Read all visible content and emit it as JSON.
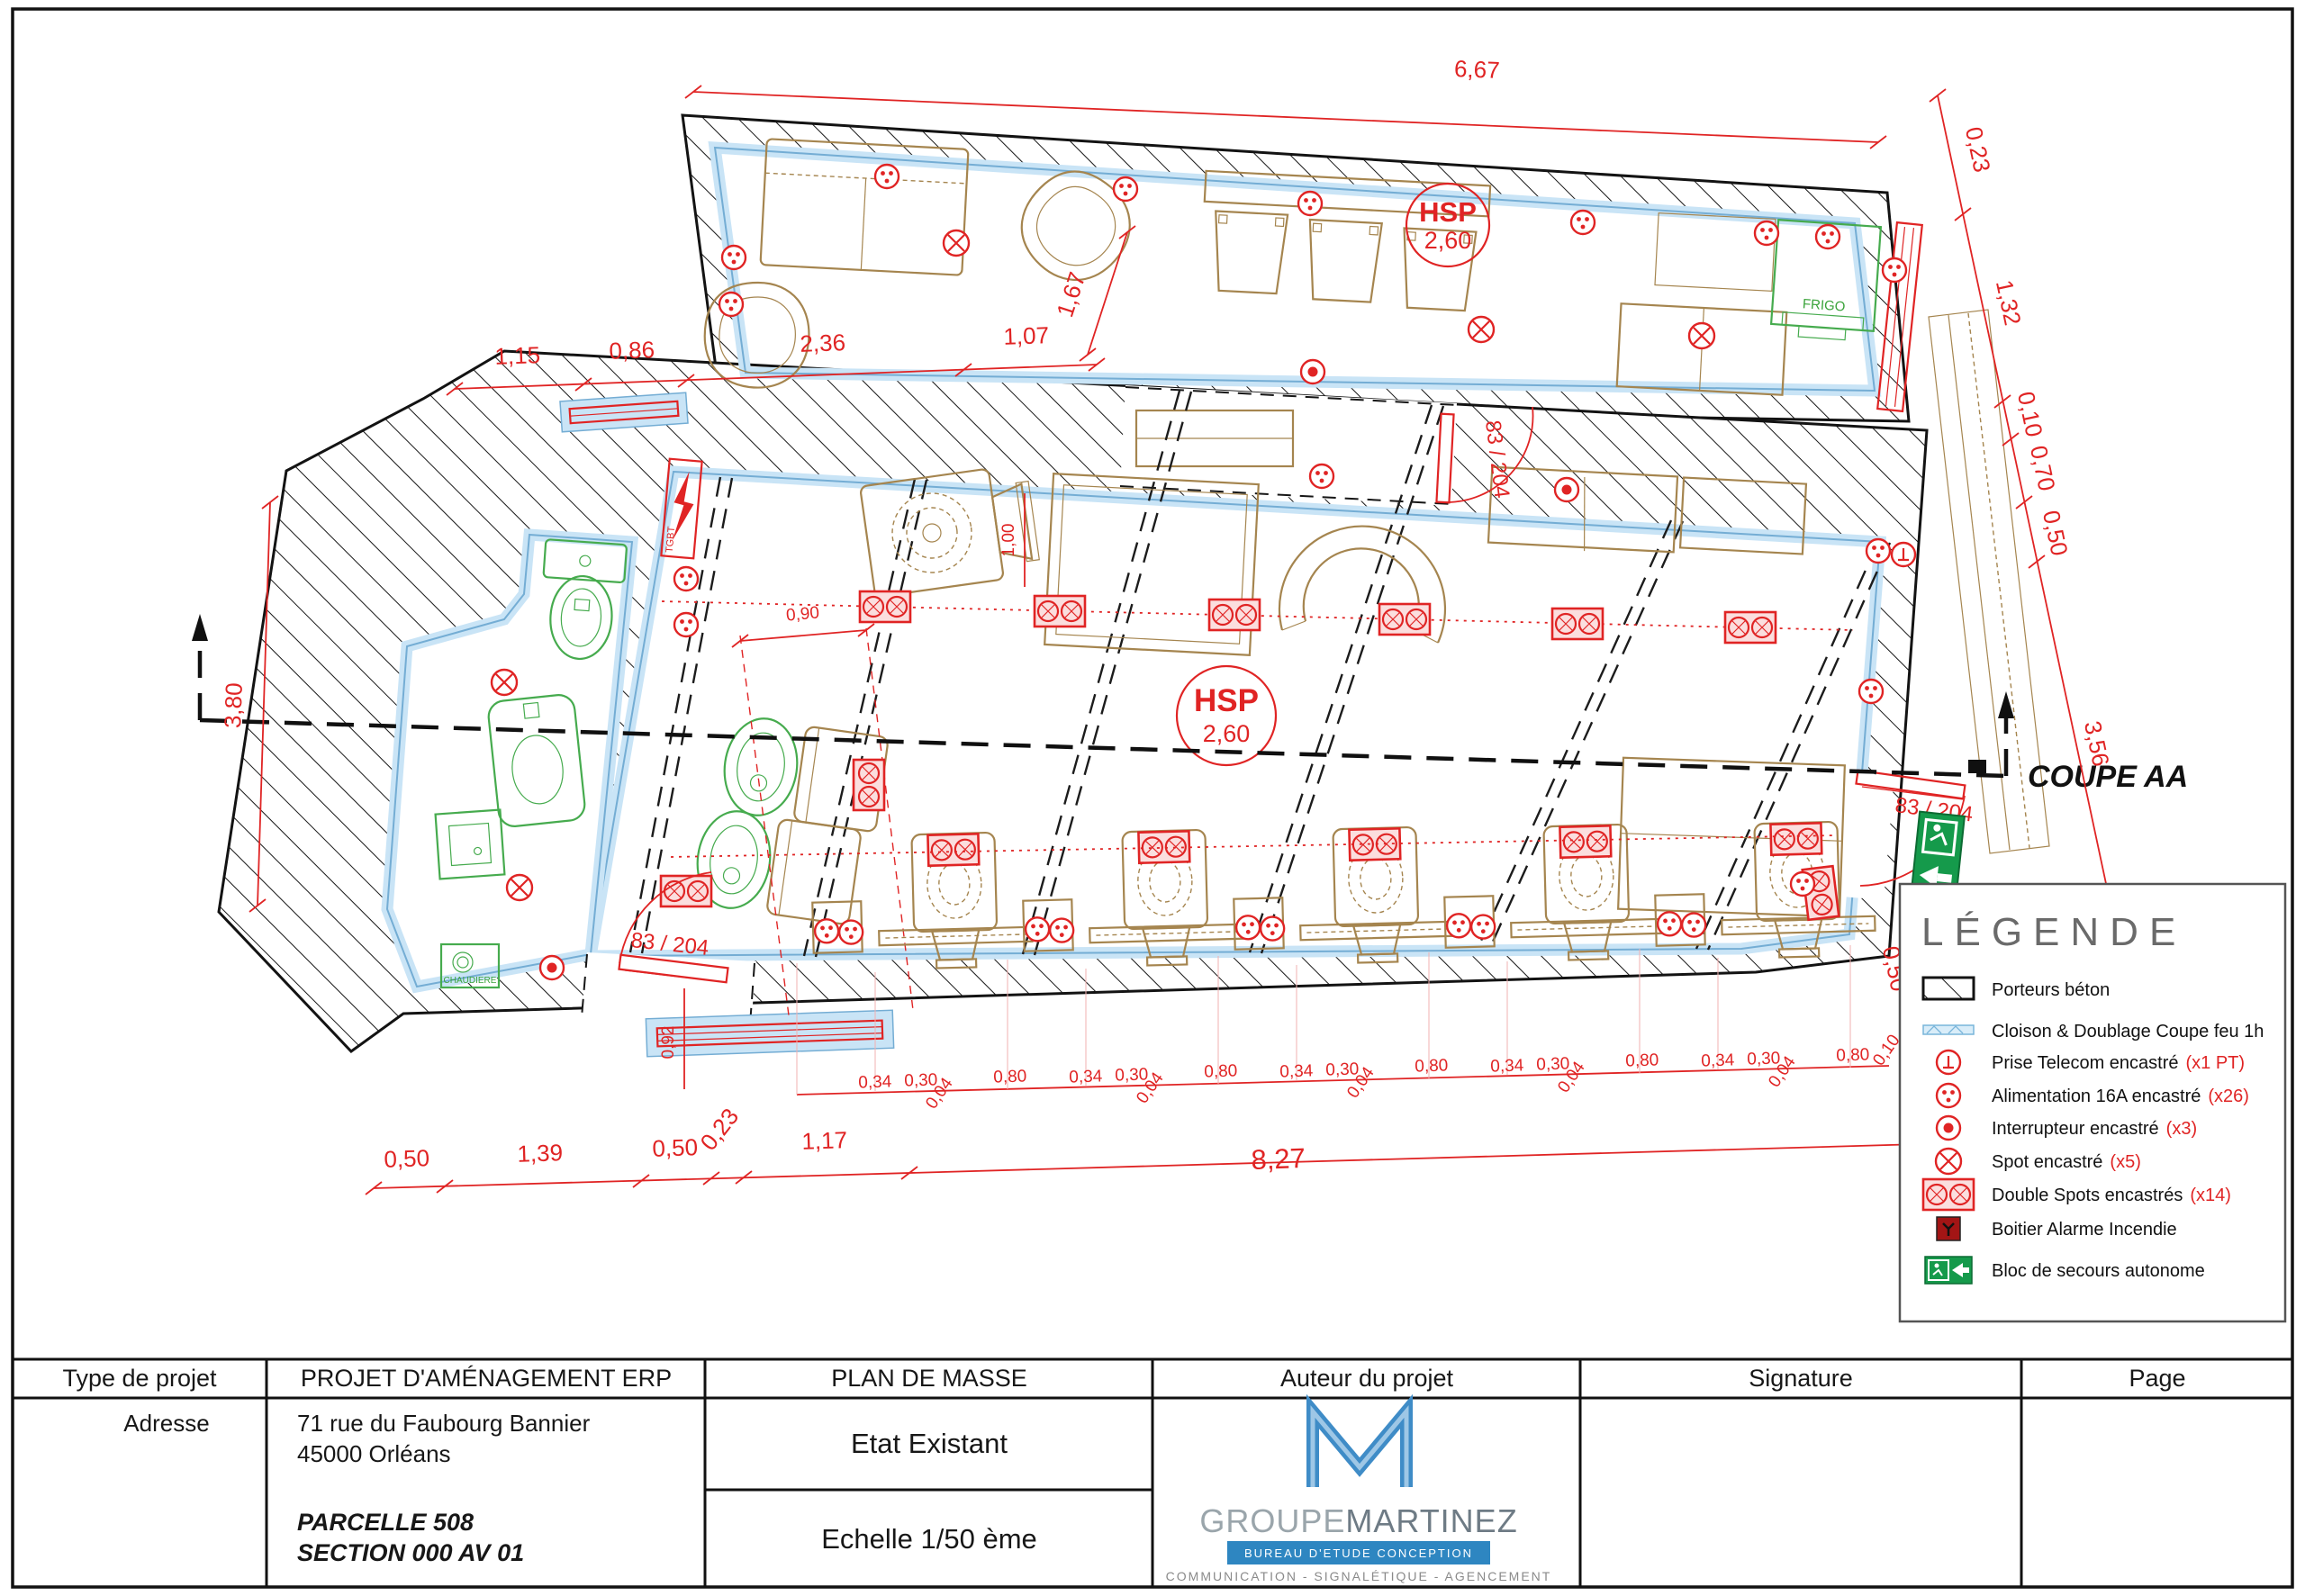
{
  "plan": {
    "coupe_label": "COUPE AA",
    "hsp": {
      "label": "HSP",
      "value": "2,60"
    },
    "door_label": "83 / 204",
    "frigo": "FRIGO",
    "chaudiere": "CHAUDIERE",
    "panel": "TGBT",
    "dims": {
      "top": "6,67",
      "top_chain": [
        "1,15",
        "0,86",
        "2,36",
        "1,07"
      ],
      "diag": "1,67",
      "left": "3,80",
      "bottom_chain": [
        "0,50",
        "1,39",
        "0,50",
        "0,23",
        "1,17",
        "8,27",
        "0,50"
      ],
      "right_chain": [
        "0,23",
        "1,32",
        "0,10",
        "0,70",
        "0,50",
        "3,56"
      ],
      "right_small": "0,50",
      "width_090": "0,90",
      "height_100": "1,00",
      "height_092": "0,92",
      "station_group": {
        "a": "0,34",
        "b": "0,30",
        "c": "0,04",
        "d": "0,80"
      },
      "station_end": "0,10"
    }
  },
  "legend": {
    "title": "LÉGENDE",
    "items": [
      {
        "icon": "porteurs-beton-swatch",
        "label": "Porteurs béton",
        "count": ""
      },
      {
        "icon": "cloison-swatch",
        "label": "Cloison & Doublage Coupe feu 1h",
        "count": ""
      },
      {
        "icon": "prise-telecom-icon",
        "label": "Prise Telecom encastré",
        "count": "(x1 PT)"
      },
      {
        "icon": "alimentation-icon",
        "label": "Alimentation 16A encastré",
        "count": "(x26)"
      },
      {
        "icon": "interrupteur-icon",
        "label": "Interrupteur encastré",
        "count": "(x3)"
      },
      {
        "icon": "spot-icon",
        "label": "Spot encastré",
        "count": "(x5)"
      },
      {
        "icon": "double-spots-icon",
        "label": "Double Spots encastrés",
        "count": "(x14)"
      },
      {
        "icon": "alarme-icon",
        "label": "Boitier Alarme Incendie",
        "count": ""
      },
      {
        "icon": "secours-icon",
        "label": "Bloc de secours autonome",
        "count": ""
      }
    ]
  },
  "title_block": {
    "headers": [
      "Type de projet",
      "PROJET D'AMÉNAGEMENT ERP",
      "PLAN DE MASSE",
      "Auteur du projet",
      "Signature",
      "Page"
    ],
    "address_label": "Adresse",
    "address_line1": "71 rue du Faubourg Bannier",
    "address_line2": "45000 Orléans",
    "parcel_line1": "PARCELLE 508",
    "parcel_line2": "SECTION 000 AV 01",
    "doc_state": "Etat Existant",
    "doc_scale": "Echelle 1/50 ème",
    "logo": {
      "name1": "GROUPE",
      "name2": "MARTINEZ",
      "subtitle": "BUREAU D'ETUDE CONCEPTION",
      "tagline": "COMMUNICATION - SIGNALÉTIQUE - AGENCEMENT"
    }
  }
}
